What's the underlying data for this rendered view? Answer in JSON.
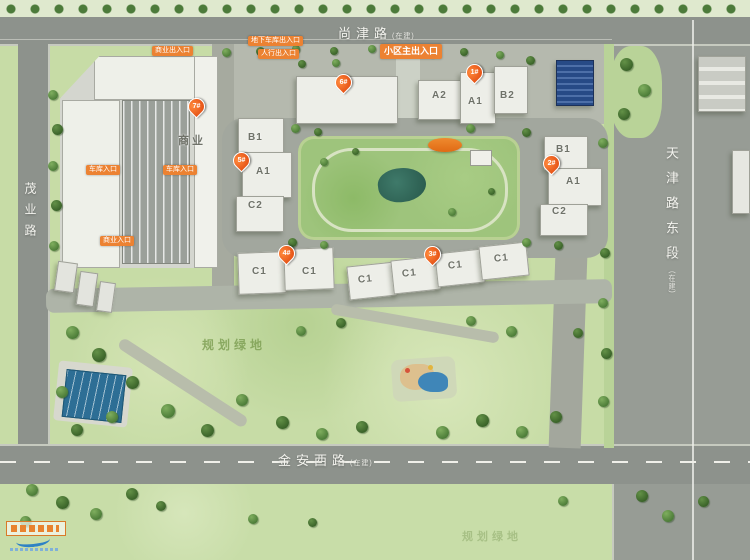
{
  "roads": {
    "top": {
      "name": "尚津路",
      "suffix": "(在建)"
    },
    "left": {
      "name": "茂业路",
      "suffix": ""
    },
    "right": {
      "name": "天津路东段",
      "suffix": "(在建)"
    },
    "bottom": {
      "name": "金安西路",
      "suffix": "(在建)"
    }
  },
  "entrances": {
    "biz_top": "商业出入口",
    "garage_top": "地下车库出入口",
    "ped_top": "人行出入口",
    "main": "小区主出入口",
    "west1": "车库入口",
    "west2": "车库入口",
    "south": "商业入口"
  },
  "pins": [
    {
      "num": "7#"
    },
    {
      "num": "6#"
    },
    {
      "num": "1#"
    },
    {
      "num": "5#"
    },
    {
      "num": "2#"
    },
    {
      "num": "4#"
    },
    {
      "num": "3#"
    }
  ],
  "labels": {
    "commercial": "商业",
    "green_main": "规划绿地",
    "green_south": "规划绿地"
  },
  "units": {
    "b5": [
      "B1",
      "A1",
      "C2"
    ],
    "b2": [
      "B1",
      "A1",
      "C2"
    ],
    "b1": [
      "A2",
      "A1",
      "B2"
    ],
    "b4": [
      "C1",
      "C1"
    ],
    "b3": [
      "C1",
      "C1",
      "C1",
      "C1"
    ]
  },
  "colors": {
    "road": "#8d928c",
    "site-green": "#c7dca6",
    "pin": "#e8581a",
    "entrance": "#ec8232",
    "green-label": "#7fa055"
  }
}
